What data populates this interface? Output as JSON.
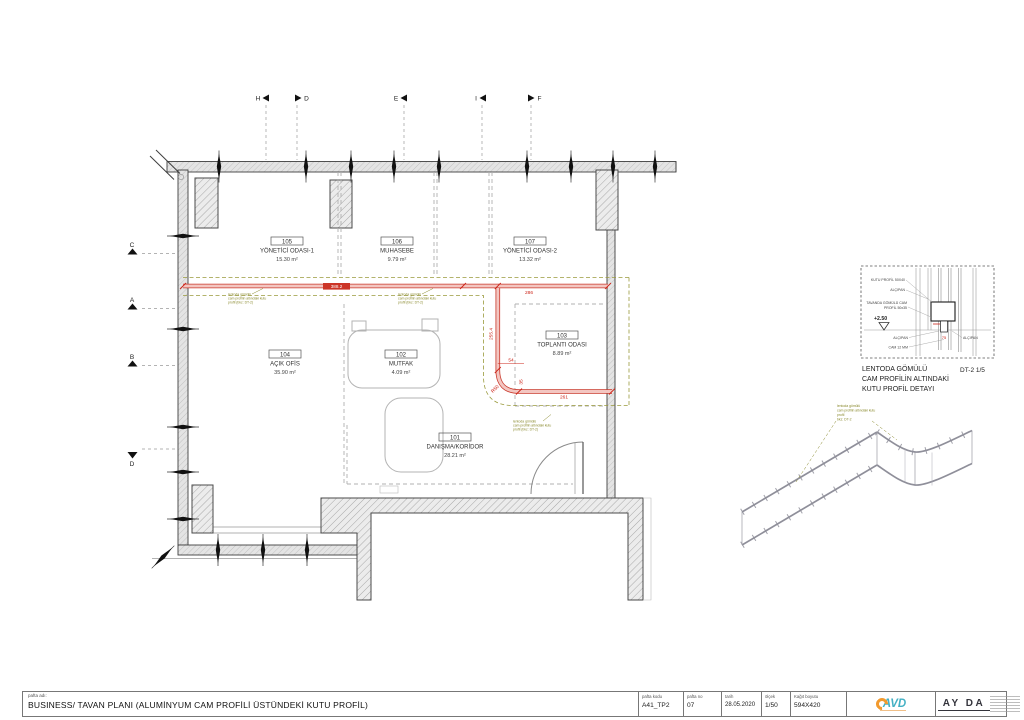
{
  "sheet": {
    "name_label": "pafta adı:",
    "title": "BUSINESS/ TAVAN PLANI (ALUMİNYUM CAM PROFİLİ ÜSTÜNDEKİ KUTU PROFİL)",
    "fields": [
      {
        "label": "pafta kodu",
        "value": "A41_TP2"
      },
      {
        "label": "pafta no",
        "value": "07"
      },
      {
        "label": "tarih",
        "value": "28.05.2020"
      },
      {
        "label": "ölçek",
        "value": "1/50"
      },
      {
        "label": "Kağıt boyutu",
        "value": "594X420"
      }
    ],
    "logo_avd": "AVD",
    "logo_ayda": "AY DA"
  },
  "grid": {
    "top": [
      "H",
      "D",
      "E",
      "I",
      "F"
    ],
    "left": [
      "C",
      "A",
      "B",
      "D"
    ]
  },
  "rooms": [
    {
      "no": "105",
      "name": "YÖNETİCİ ODASI-1",
      "area": "15.30 m²"
    },
    {
      "no": "106",
      "name": "MUHASEBE",
      "area": "9.79 m²"
    },
    {
      "no": "107",
      "name": "YÖNETİCİ ODASI-2",
      "area": "13.32 m²"
    },
    {
      "no": "103",
      "name": "TOPLANTI ODASI",
      "area": "8.89 m²"
    },
    {
      "no": "104",
      "name": "AÇIK OFİS",
      "area": "35.90 m²"
    },
    {
      "no": "102",
      "name": "MUTFAK",
      "area": "4.09 m²"
    },
    {
      "no": "101",
      "name": "DANIŞMA/KORİDOR",
      "area": "28.21 m²"
    }
  ],
  "dims": {
    "main": "388.2",
    "right": "286",
    "vertical": "255.4",
    "offset": "54",
    "offset2": "35",
    "radius": "R50",
    "bottom": "261",
    "detail_width": "75"
  },
  "callout": {
    "l1": "lentoda gömülü",
    "l2": "cam profilin altındaki kutu",
    "l3": "profil (bkz: DT-2)",
    "s3": "profil",
    "s4": "bkz: DT-2"
  },
  "detail": {
    "label_kutu": "KUTU PROFİL 50X40",
    "label_alcipan": "ALÇIPAN",
    "label_tavan1": "TAVANDA GÖMÜLÜ CAM",
    "label_tavan2": "PROFİL 50x35",
    "label_cam": "CAM 12 MM",
    "elevation": "+2.50",
    "caption1": "LENTODA GÖMÜLÜ",
    "caption2": "CAM PROFİLİN ALTINDAKİ",
    "caption3": "KUTU PROFİL DETAYI",
    "ref": "DT-2 1/5"
  }
}
